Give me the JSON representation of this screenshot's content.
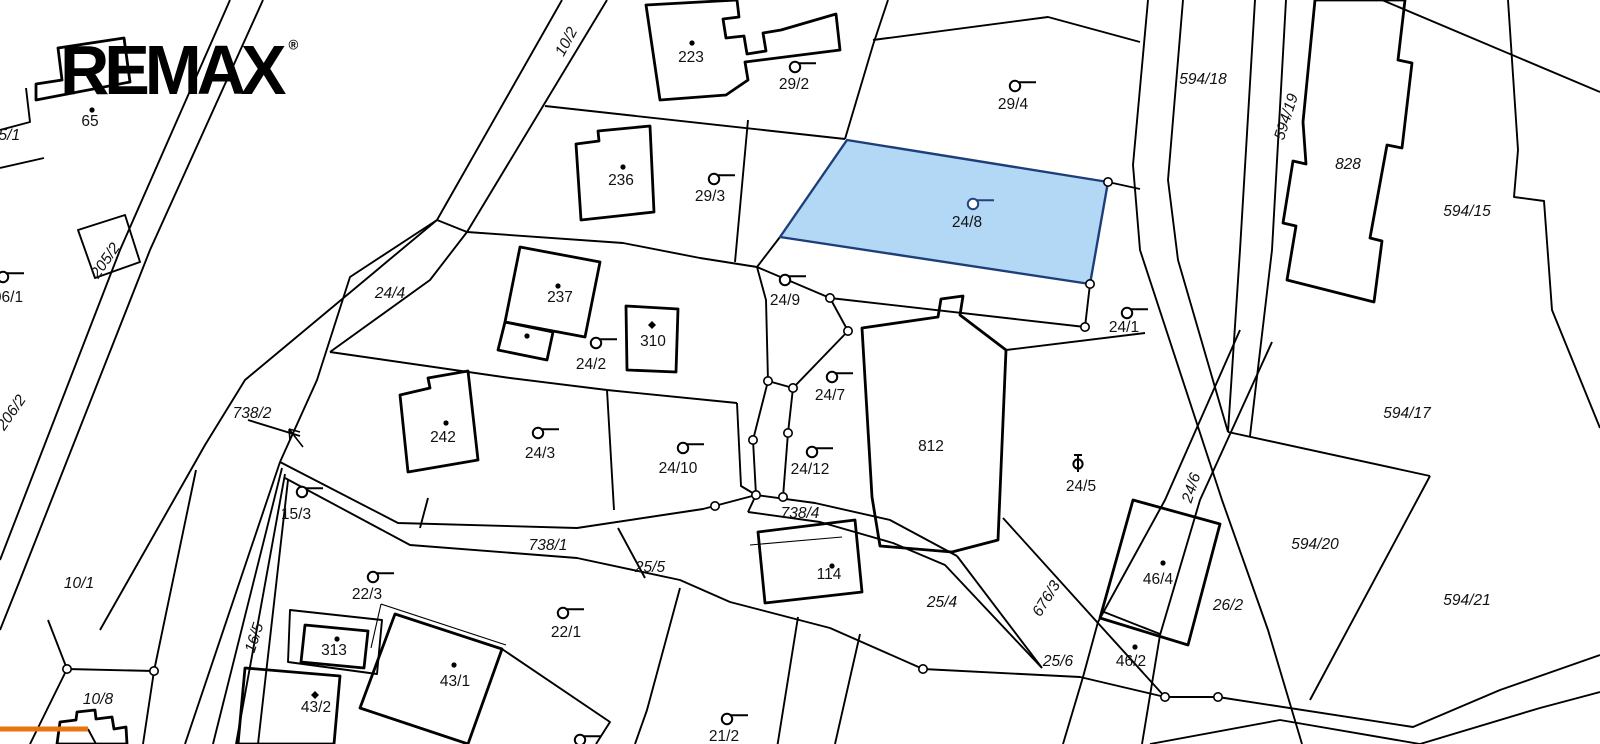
{
  "brand": {
    "logo_text": "REMAX",
    "registered_mark": "®"
  },
  "map": {
    "background": "#ffffff",
    "line_color": "#000000",
    "highlight": {
      "parcel_number": "24/8",
      "polygon": "M847,140 L1108,182 L1090,284 L780,237 Z",
      "fill": "#b3d8f6",
      "stroke": "#1d3e78",
      "label_color": "#24427c"
    },
    "orange_segment": {
      "x1": 0,
      "y1": 729,
      "x2": 88,
      "y2": 729,
      "color": "#e8740e",
      "width": 5
    },
    "north_arrow": {
      "d": "M303,447 L289,429 M289,429 L290,440 M289,429 L300,432"
    },
    "labels": [
      {
        "t": "05/1",
        "x": 5,
        "y": 136,
        "i": 1
      },
      {
        "t": "65",
        "x": 90,
        "y": 122
      },
      {
        "t": "10/2",
        "x": 567,
        "y": 42,
        "r": -62,
        "i": 1
      },
      {
        "t": "223",
        "x": 691,
        "y": 58
      },
      {
        "t": "29/2",
        "x": 794,
        "y": 85
      },
      {
        "t": "29/4",
        "x": 1013,
        "y": 105
      },
      {
        "t": "594/18",
        "x": 1203,
        "y": 80,
        "i": 1
      },
      {
        "t": "594/19",
        "x": 1287,
        "y": 117,
        "r": -72,
        "i": 1
      },
      {
        "t": "828",
        "x": 1348,
        "y": 165,
        "i": 1
      },
      {
        "t": "594/15",
        "x": 1467,
        "y": 212,
        "i": 1
      },
      {
        "t": "236",
        "x": 621,
        "y": 181
      },
      {
        "t": "29/3",
        "x": 710,
        "y": 197
      },
      {
        "t": "24/4",
        "x": 390,
        "y": 294,
        "i": 1
      },
      {
        "t": "237",
        "x": 560,
        "y": 298
      },
      {
        "t": "24/2",
        "x": 591,
        "y": 365
      },
      {
        "t": "310",
        "x": 653,
        "y": 342
      },
      {
        "t": "242",
        "x": 443,
        "y": 438
      },
      {
        "t": "24/3",
        "x": 540,
        "y": 454
      },
      {
        "t": "24/10",
        "x": 678,
        "y": 469
      },
      {
        "t": "24/9",
        "x": 785,
        "y": 301
      },
      {
        "t": "24/8",
        "x": 967,
        "y": 223,
        "c": "#24427c"
      },
      {
        "t": "24/1",
        "x": 1124,
        "y": 328
      },
      {
        "t": "24/7",
        "x": 830,
        "y": 396
      },
      {
        "t": "24/12",
        "x": 810,
        "y": 470
      },
      {
        "t": "812",
        "x": 931,
        "y": 447
      },
      {
        "t": "24/5",
        "x": 1081,
        "y": 487
      },
      {
        "t": "24/6",
        "x": 1192,
        "y": 488,
        "r": -72,
        "i": 1
      },
      {
        "t": "594/17",
        "x": 1407,
        "y": 414,
        "i": 1
      },
      {
        "t": "06/1",
        "x": 8,
        "y": 298
      },
      {
        "t": "205/2",
        "x": 106,
        "y": 261,
        "r": -55,
        "i": 1
      },
      {
        "t": "206/2",
        "x": 12,
        "y": 413,
        "r": -55,
        "i": 1
      },
      {
        "t": "738/2",
        "x": 252,
        "y": 414,
        "i": 1
      },
      {
        "t": "10/1",
        "x": 79,
        "y": 584,
        "i": 1
      },
      {
        "t": "15/3",
        "x": 296,
        "y": 515
      },
      {
        "t": "738/1",
        "x": 548,
        "y": 546,
        "i": 1
      },
      {
        "t": "25/5",
        "x": 650,
        "y": 568,
        "i": 1
      },
      {
        "t": "22/3",
        "x": 367,
        "y": 595
      },
      {
        "t": "22/1",
        "x": 566,
        "y": 633
      },
      {
        "t": "16/5",
        "x": 255,
        "y": 638,
        "r": -72,
        "i": 1
      },
      {
        "t": "313",
        "x": 334,
        "y": 651
      },
      {
        "t": "43/1",
        "x": 455,
        "y": 682
      },
      {
        "t": "43/2",
        "x": 316,
        "y": 708
      },
      {
        "t": "10/8",
        "x": 98,
        "y": 700,
        "i": 1
      },
      {
        "t": "738/4",
        "x": 800,
        "y": 514,
        "i": 1
      },
      {
        "t": "114",
        "x": 829,
        "y": 575
      },
      {
        "t": "25/4",
        "x": 942,
        "y": 603,
        "i": 1
      },
      {
        "t": "676/3",
        "x": 1047,
        "y": 599,
        "r": -58,
        "i": 1
      },
      {
        "t": "25/6",
        "x": 1058,
        "y": 662,
        "i": 1,
        "s": 13
      },
      {
        "t": "46/2",
        "x": 1131,
        "y": 662
      },
      {
        "t": "46/4",
        "x": 1158,
        "y": 580
      },
      {
        "t": "26/2",
        "x": 1228,
        "y": 606,
        "i": 1
      },
      {
        "t": "594/20",
        "x": 1315,
        "y": 545,
        "i": 1
      },
      {
        "t": "594/21",
        "x": 1467,
        "y": 601,
        "i": 1
      },
      {
        "t": "21/2",
        "x": 724,
        "y": 737
      }
    ],
    "symbols": [
      {
        "type": "flag",
        "x": 795,
        "y": 67
      },
      {
        "type": "flag",
        "x": 1015,
        "y": 86
      },
      {
        "type": "flag",
        "x": 714,
        "y": 179
      },
      {
        "type": "flag",
        "x": 785,
        "y": 280
      },
      {
        "type": "flag",
        "x": 973,
        "y": 204,
        "c": "#24427c"
      },
      {
        "type": "flag",
        "x": 1127,
        "y": 313
      },
      {
        "type": "flag",
        "x": 596,
        "y": 343
      },
      {
        "type": "flag",
        "x": 538,
        "y": 433
      },
      {
        "type": "flag",
        "x": 683,
        "y": 448
      },
      {
        "type": "flag",
        "x": 832,
        "y": 377
      },
      {
        "type": "flag",
        "x": 812,
        "y": 452
      },
      {
        "type": "flag",
        "x": 302,
        "y": 492
      },
      {
        "type": "flag",
        "x": 373,
        "y": 577
      },
      {
        "type": "flag",
        "x": 563,
        "y": 613
      },
      {
        "type": "flag",
        "x": 727,
        "y": 719
      },
      {
        "type": "flag",
        "x": 580,
        "y": 740
      },
      {
        "type": "flag",
        "x": 3,
        "y": 277
      },
      {
        "type": "theta",
        "x": 1078,
        "y": 464
      },
      {
        "type": "dot",
        "x": 92,
        "y": 110
      },
      {
        "type": "dot",
        "x": 692,
        "y": 43
      },
      {
        "type": "dot",
        "x": 623,
        "y": 167
      },
      {
        "type": "dot",
        "x": 558,
        "y": 286
      },
      {
        "type": "dot",
        "x": 527,
        "y": 336
      },
      {
        "type": "dot",
        "x": 446,
        "y": 423
      },
      {
        "type": "dot",
        "x": 337,
        "y": 639
      },
      {
        "type": "dot",
        "x": 454,
        "y": 665
      },
      {
        "type": "dot",
        "x": 832,
        "y": 566
      },
      {
        "type": "dot",
        "x": 1163,
        "y": 563
      },
      {
        "type": "dot",
        "x": 1135,
        "y": 647
      },
      {
        "type": "diamond",
        "x": 652,
        "y": 325
      },
      {
        "type": "diamond",
        "x": 315,
        "y": 695
      }
    ],
    "vertices": [
      {
        "x": 830,
        "y": 298
      },
      {
        "x": 1085,
        "y": 327
      },
      {
        "x": 768,
        "y": 381
      },
      {
        "x": 753,
        "y": 440
      },
      {
        "x": 756,
        "y": 495
      },
      {
        "x": 848,
        "y": 331
      },
      {
        "x": 793,
        "y": 388
      },
      {
        "x": 788,
        "y": 433
      },
      {
        "x": 783,
        "y": 497
      },
      {
        "x": 1108,
        "y": 182
      },
      {
        "x": 1090,
        "y": 284
      },
      {
        "x": 923,
        "y": 669
      },
      {
        "x": 1218,
        "y": 697
      },
      {
        "x": 1165,
        "y": 697
      },
      {
        "x": 67,
        "y": 669
      },
      {
        "x": 154,
        "y": 671
      },
      {
        "x": 715,
        "y": 506
      }
    ],
    "paths": [
      {
        "d": "M562,0 L437,220 L350,277 L317,380 L280,462"
      },
      {
        "d": "M607,0 L467,232"
      },
      {
        "d": "M467,232 L623,243 L700,258 L757,267"
      },
      {
        "d": "M545,106 L845,139"
      },
      {
        "d": "M1108,182 L1140,189"
      },
      {
        "d": "M888,0 L873,45 L845,139"
      },
      {
        "d": "M873,40 L1048,17 L1140,42"
      },
      {
        "d": "M748,120 L735,262"
      },
      {
        "d": "M780,237 L757,267"
      },
      {
        "d": "M757,267 L830,298 L1085,327"
      },
      {
        "d": "M1090,284 L1085,327"
      },
      {
        "d": "M757,267 L766,300 L768,381 L753,440 L756,495"
      },
      {
        "d": "M830,298 L848,331 L793,388 L788,433 L783,497"
      },
      {
        "d": "M768,381 L793,388"
      },
      {
        "d": "M330,352 L510,378 L607,390 L737,403"
      },
      {
        "d": "M737,403 L741,486 L756,495"
      },
      {
        "d": "M607,390 L614,510"
      },
      {
        "d": "M467,232 L430,280 L330,352"
      },
      {
        "d": "M280,462 L398,523 L577,528 L703,509 L756,495"
      },
      {
        "d": "M285,478 L410,545 L577,558 L680,580 L730,602 L830,628 L923,669 L1080,677 L1165,697 L1218,697 L1413,727 L1500,690 L1600,655"
      },
      {
        "d": "M1150,744 L1280,720 L1420,744 L1540,708 L1600,692"
      },
      {
        "d": "M756,495 L815,503 L890,520 L957,556"
      },
      {
        "d": "M748,512 L820,522 L893,543 L945,565 L1042,668"
      },
      {
        "d": "M1003,518 L1097,622 L1165,697"
      },
      {
        "d": "M957,556 L1042,668"
      },
      {
        "d": "M1006,350 L1145,333"
      },
      {
        "d": "M750,545 L842,537",
        "k": "thin"
      },
      {
        "d": "M1104,612 L1160,634"
      },
      {
        "d": "M1148,0 L1133,165 L1140,250 L1222,500 L1268,630 L1302,744"
      },
      {
        "d": "M1183,0 L1168,180 L1178,260 L1228,432"
      },
      {
        "d": "M1240,330 L1165,500 L1098,622 L1083,677 L1063,744"
      },
      {
        "d": "M1272,342 L1200,500 L1160,635 L1142,744"
      },
      {
        "d": "M1228,432 L1430,476"
      },
      {
        "d": "M1430,476 L1310,700"
      },
      {
        "d": "M1255,0 L1240,250 L1228,432"
      },
      {
        "d": "M1286,0 L1272,250 L1250,436"
      },
      {
        "d": "M1382,0 L1600,92"
      },
      {
        "d": "M1508,0 L1518,150 L1514,197 L1544,201 L1552,310 L1600,428"
      },
      {
        "d": "M230,0 L120,250 L0,560"
      },
      {
        "d": "M263,0 L150,250 L20,580 L0,630"
      },
      {
        "d": "M67,669 L154,671 M154,671 L143,744 M67,669 L30,744 M67,669 L48,620"
      },
      {
        "d": "M154,671 L196,470"
      },
      {
        "d": "M280,462 L185,744"
      },
      {
        "d": "M282,468 L213,744"
      },
      {
        "d": "M285,474 L236,744"
      },
      {
        "d": "M288,480 L258,744"
      },
      {
        "d": "M437,220 L245,380 L205,445 L100,630"
      },
      {
        "d": "M248,420 L300,436"
      },
      {
        "d": "M428,498 L420,528"
      },
      {
        "d": "M798,617 L777,748"
      },
      {
        "d": "M680,588 L647,710 L635,744"
      },
      {
        "d": "M860,634 L835,744"
      },
      {
        "d": "M290,610 L382,620 L377,674 L288,662 Z"
      },
      {
        "d": "M502,649 L610,722 L596,744"
      },
      {
        "d": "M437,220 L467,232"
      },
      {
        "d": "M756,495 L748,512"
      },
      {
        "d": "M78,230 L125,215 L140,262 L95,278 Z"
      },
      {
        "d": "M0,130 L30,122 L26,88 M0,168 L44,158"
      },
      {
        "d": "M618,528 L645,578"
      },
      {
        "d": "M88,729 L96,744"
      },
      {
        "d": "M381,604 L506,645 M381,604 L371,648",
        "k": "thin"
      },
      {
        "d": "M36,100 L130,82 L124,38 L58,48 L62,80 L36,84 Z",
        "k": "b"
      },
      {
        "d": "M646,5 L737,0 L739,17 L723,19 L726,38 L744,36 L747,54 L766,51 L763,33 L781,30 L836,14 L840,50 L745,62 L748,80 L726,95 L660,100 Z",
        "k": "b"
      },
      {
        "d": "M576,144 L599,141 L598,131 L650,126 L654,212 L581,220 Z",
        "k": "b"
      },
      {
        "d": "M520,247 L600,262 L585,337 L505,322 Z",
        "k": "b"
      },
      {
        "d": "M505,322 L553,332 L547,360 L498,350 Z",
        "k": "b"
      },
      {
        "d": "M626,306 L678,309 L676,372 L627,370 Z",
        "k": "b"
      },
      {
        "d": "M400,395 L430,388 L428,378 L468,371 L478,460 L408,472 Z",
        "k": "b"
      },
      {
        "d": "M862,328 L938,317 L941,299 L963,296 L960,315 L1006,350 L998,540 L952,552 L880,546 L872,497 Z",
        "k": "b"
      },
      {
        "d": "M758,532 L855,520 L862,592 L765,603 Z",
        "k": "b"
      },
      {
        "d": "M1133,500 L1220,524 L1188,645 L1100,618 Z",
        "k": "b"
      },
      {
        "d": "M1315,0 L1405,0 L1398,60 L1412,63 L1402,148 L1387,145 L1370,238 L1382,241 L1374,302 L1287,280 L1296,226 L1283,223 L1293,161 L1306,164 L1303,122 Z",
        "k": "b"
      },
      {
        "d": "M305,625 L368,631 L364,668 L301,662 Z",
        "k": "b"
      },
      {
        "d": "M245,668 L340,676 L334,744 L238,744 Z",
        "k": "b"
      },
      {
        "d": "M395,614 L502,649 L468,744 L360,708 Z",
        "k": "b"
      },
      {
        "d": "M57,744 L60,722 L76,720 L77,712 L95,710 L96,719 L112,717 L114,729 L126,727 L127,744 Z",
        "k": "b"
      }
    ]
  }
}
